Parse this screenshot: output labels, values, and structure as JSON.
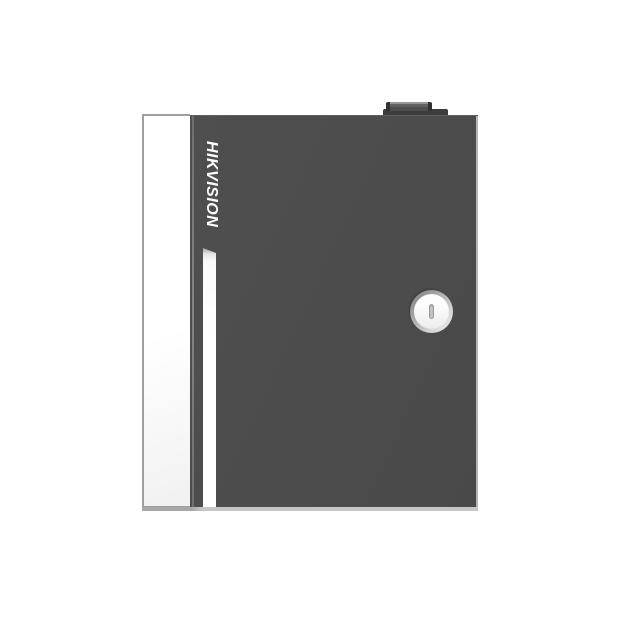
{
  "scene": {
    "type": "product-photo",
    "background_color": "#ffffff",
    "subject": "Wall-mount access controller enclosure, front view"
  },
  "device": {
    "brand_logo": "HIKVISION",
    "features": {
      "side_panel": "white left side panel",
      "accent_stripe": "white vertical stripe on door",
      "lock": "round cam lock with vertical key slot",
      "top_block": "hinge / cable entry block on top edge"
    },
    "colors": {
      "door": "#4d4d4d",
      "door_top_edge": "#5e5e5e",
      "door_right_edge": "#cfcfcf",
      "side_panel": "#fbfbfb",
      "side_panel_border": "#9f9f9f",
      "accent_stripe": "#ffffff",
      "hinge_highlight": "#7a7a7a",
      "bottom_edge": "#c4c4c4",
      "top_block": "#3d3d3d",
      "lock_ring": "#b3b3b3",
      "lock_face": "#f7f7f7",
      "lock_slot": "#cdcdcd",
      "logo_text": "#fdfdfd"
    }
  }
}
